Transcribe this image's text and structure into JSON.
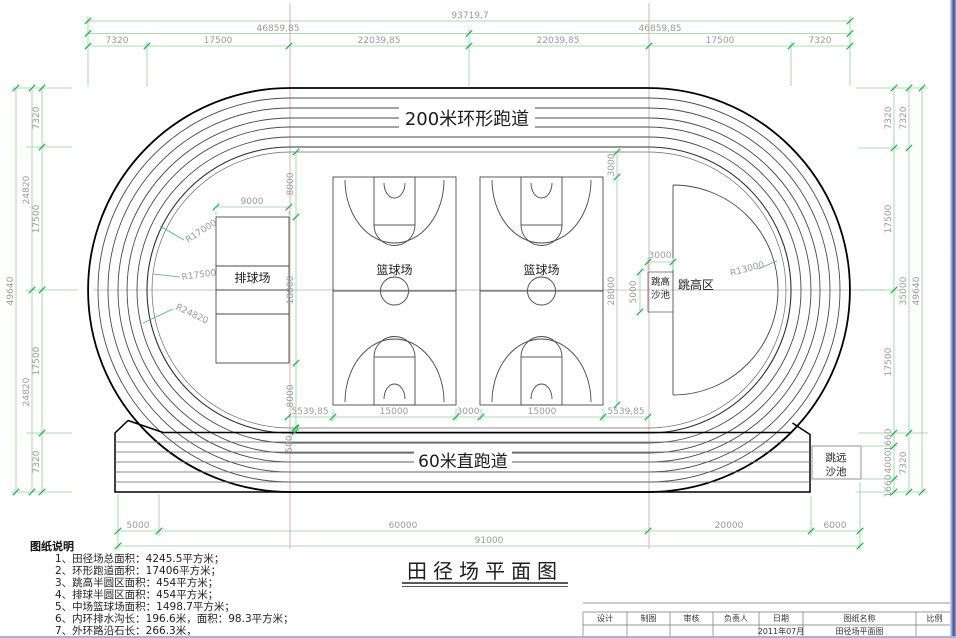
{
  "labels": {
    "ring_track": "200米环形跑道",
    "straight_track": "60米直跑道",
    "volleyball": "排球场",
    "basketball": "篮球场",
    "high_jump_area": "跳高区",
    "high_jump_pit_l1": "跳高",
    "high_jump_pit_l2": "沙池",
    "long_jump_pit_l1": "跳远",
    "long_jump_pit_l2": "沙池",
    "drawing_title": "田径场平面图"
  },
  "radii": {
    "r17000": "R17000",
    "r17500": "R17500",
    "r24820": "R24820",
    "r13000": "R13000"
  },
  "dims": {
    "d93719": "93719,7",
    "d46859": "46859,85",
    "d7320": "7320",
    "d17500": "17500",
    "d22039": "22039,85",
    "d49640": "49640",
    "d24820": "24820",
    "d35000": "35000",
    "d1660": "1660",
    "d4000": "4000",
    "d5000": "5000",
    "d60000": "60000",
    "d20000": "20000",
    "d6000": "6000",
    "d91000": "91000",
    "d9000": "9000",
    "d18000": "18000",
    "d8000": "8000",
    "d28000": "28000",
    "d3000": "3000",
    "d15000": "15000",
    "d5539": "5539,85",
    "d500": "500"
  },
  "notes": {
    "title": "图纸说明",
    "items": [
      "1、田径场总面积：4245.5平方米；",
      "2、环形跑道面积：17406平方米；",
      "3、跳高半圆区面积：454平方米；",
      "4、排球半圆区面积：454平方米；",
      "5、中场篮球场面积：1498.7平方米；",
      "6、内环排水沟长：196.6米，面积：98.3平方米；",
      "7、外环路沿石长：266.3米，"
    ]
  },
  "titleblock": {
    "headers": [
      "设计",
      "制图",
      "审核",
      "负责人",
      "日期",
      "图纸名称",
      "比例"
    ],
    "date_value": "2011年07月",
    "name_value": "田径场平面图"
  }
}
